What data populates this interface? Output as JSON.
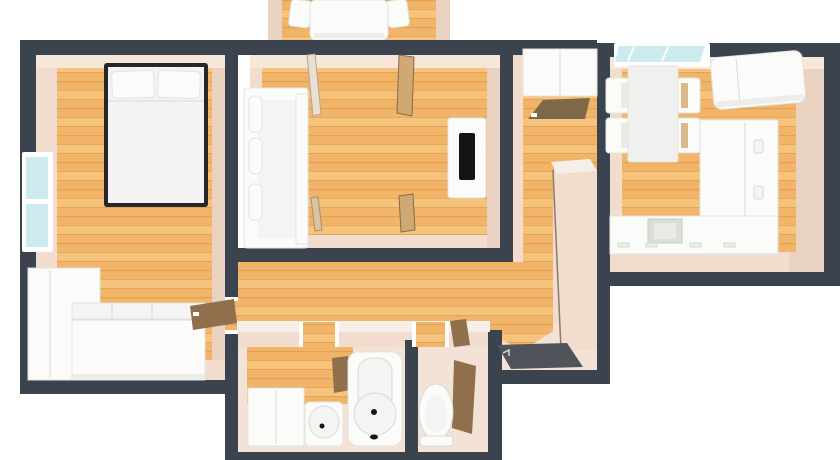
{
  "meta": {
    "title": "3D apartment floor plan, top-down view",
    "style": "rendered 3D floorplan with cut walls"
  },
  "palette": {
    "background": "#ffffff",
    "wall": "#3a434e",
    "wallCap": "#f4efe9",
    "wood": "#f1b468",
    "woodLight": "#f6c37c",
    "woodStripe": "#dfa04f",
    "bevel": "#f1dcce",
    "bevelLight": "#f7e6da",
    "bevelDark": "#e9d2c1",
    "beigeFloor": "#f2e3d6",
    "furnitureWhite": "#fbfbf9",
    "furnitureShade": "#ececea",
    "bedFrame": "#26262b",
    "glass": "#cdeaef",
    "doorBrown": "#8f6f4c",
    "doormatBrown": "#7d6848",
    "entranceMat": "#4e545a",
    "tvBlack": "#141414"
  },
  "rooms": [
    {
      "id": "balcony",
      "furniture": [
        "balcony-table",
        "balcony-chair-left",
        "balcony-chair-right"
      ]
    },
    {
      "id": "bedroom",
      "furniture": [
        "double-bed",
        "pillows",
        "wardrobe-sofa-unit",
        "window",
        "open-door"
      ]
    },
    {
      "id": "living-room",
      "furniture": [
        "sofa",
        "tv-stand",
        "tv",
        "balcony-door-leaf",
        "hall-door-leaf"
      ]
    },
    {
      "id": "entry-hall",
      "furniture": [
        "cabinet",
        "door-mat",
        "entrance-mat"
      ]
    },
    {
      "id": "kitchen",
      "furniture": [
        "window",
        "fridge",
        "dining-table",
        "chairs",
        "cabinet-run",
        "counter",
        "sink"
      ]
    },
    {
      "id": "bathroom",
      "furniture": [
        "washing-machine",
        "wash-basin",
        "bathtub",
        "open-door"
      ]
    },
    {
      "id": "wc",
      "furniture": [
        "toilet",
        "open-door"
      ]
    }
  ]
}
